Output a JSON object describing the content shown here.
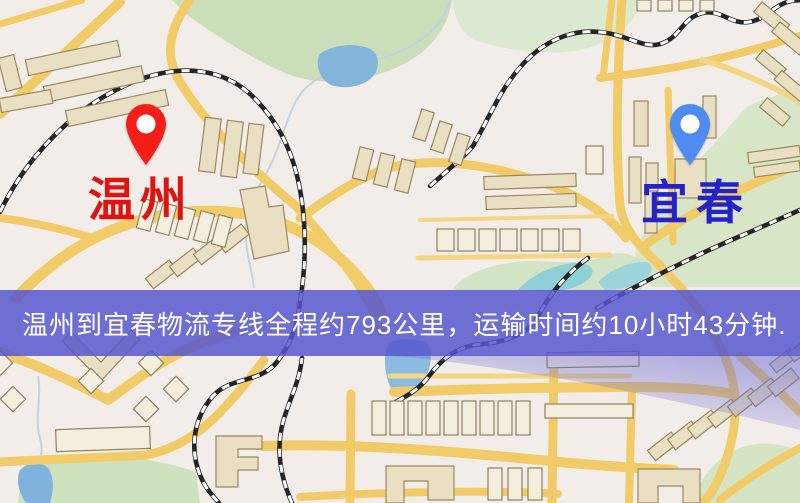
{
  "banner": {
    "text": "温州到宜春物流专线全程约793公里，运输时间约10小时43分钟.",
    "background_color": "#5656cd",
    "text_color": "#ffffff"
  },
  "route": {
    "origin": {
      "name": "温州",
      "pin_color": "#f51d18",
      "label_color": "#de1412"
    },
    "destination": {
      "name": "宜春",
      "pin_color": "#4f8cf2",
      "label_color": "#2323c8"
    },
    "distance_text": "约793公里",
    "duration_text": "约10小时43分钟"
  },
  "map": {
    "style_colors": {
      "background": "#f3edea",
      "road": "#f2cb69",
      "park": "#cfe2c0",
      "water": "#83b5db",
      "building": "#e9dfc2",
      "railway": "#252525"
    }
  }
}
